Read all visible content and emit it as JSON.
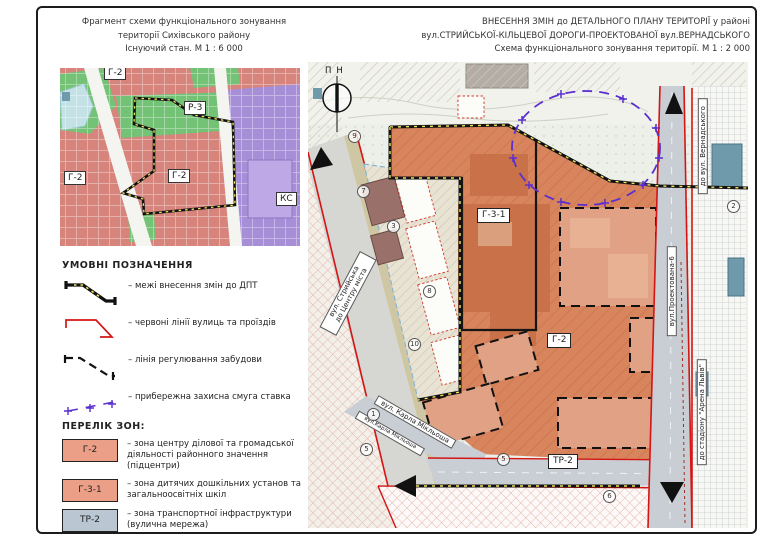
{
  "titles": {
    "left": [
      "Фрагмент схеми функціонального зонування",
      "території Сихівського району",
      "Існуючий стан. М 1 : 6 000"
    ],
    "right": [
      "ВНЕСЕННЯ ЗМІН до ДЕТАЛЬНОГО ПЛАНУ ТЕРИТОРІЇ у районі",
      "вул.СТРИЙСЬКОЇ-КІЛЬЦЕВОЇ ДОРОГИ-ПРОЕКТОВАНОЇ вул.ВЕРНАДСЬКОГО",
      "Схема функціонального зонування території. М 1 : 2 000"
    ]
  },
  "mini_map": {
    "labels": [
      "Г-2",
      "Р-3",
      "Г-2",
      "Г-2",
      "КС"
    ]
  },
  "legend": {
    "title": "УМОВНІ ПОЗНАЧЕННЯ",
    "items": [
      {
        "symbol": "change-boundary-line",
        "label": "– межі внесення змін до ДПТ"
      },
      {
        "symbol": "red-street-line",
        "label": "– червоні лінії вулиць та проїздів"
      },
      {
        "symbol": "building-regulation-line",
        "label": "– лінія регулювання забудови"
      },
      {
        "symbol": "pond-protection-line",
        "label": "– прибережна захисна смуга ставка"
      }
    ]
  },
  "zones": {
    "title": "ПЕРЕЛІК ЗОН:",
    "items": [
      {
        "code": "Г-2",
        "desc": "– зона центру ділової та громадської діяльності районного значення (підцентри)"
      },
      {
        "code": "Г-3-1",
        "desc": "– зона дитячих дошкільних установ та загальноосвітніх шкіл"
      },
      {
        "code": "ТР-2",
        "desc": "– зона транспортної інфраструктури (вулична мережа)"
      }
    ]
  },
  "main_map": {
    "compass": "ПН",
    "zone_labels": {
      "g31": "Г-3-1",
      "g2": "Г-2",
      "tr2": "ТР-2"
    },
    "streets": {
      "stryiska_line1": "вул. Стрийська",
      "stryiska_line2": "до Центру міста",
      "miklosha": "вул. Карла Мікльоша",
      "miklosha_small": "вул.Карла Мікльоша",
      "proektovana": "вул.Проектована-6",
      "vernadskoho": "до вул. Вернадського",
      "arena": "до стадіону \"Арена Львів\""
    },
    "circled": [
      "9",
      "7",
      "3",
      "8",
      "10",
      "1",
      "5",
      "5",
      "6",
      "2"
    ]
  },
  "colors": {
    "zone_g2_legend": "#eb9f87",
    "zone_tr2_legend": "#bac6d2",
    "map_zone_orange": "#d8845c",
    "red_line": "#d51414",
    "purple_line": "#5a2fd0",
    "yellow_dash": "#f2e35e",
    "mini_pink": "#d7847c",
    "mini_green": "#74c276",
    "mini_purple": "#a78fd8",
    "mini_water": "#c4e2e6"
  }
}
